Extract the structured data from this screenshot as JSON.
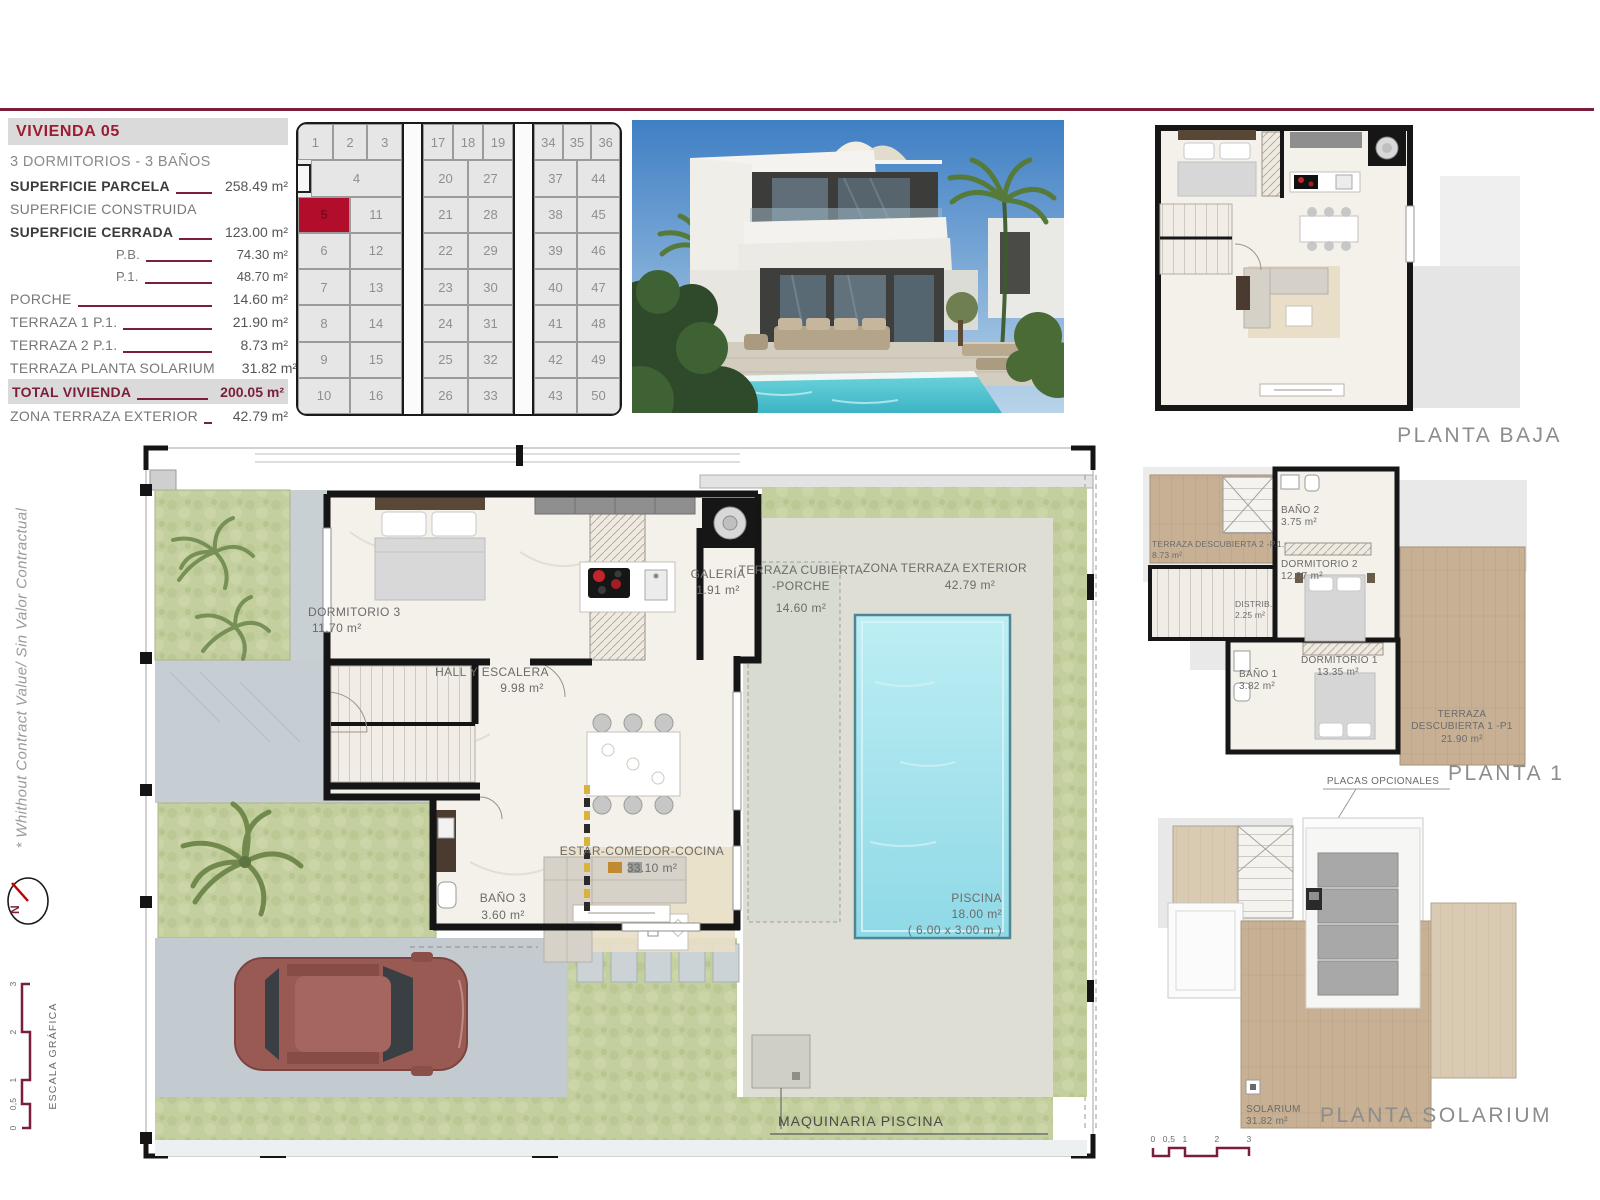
{
  "info_panel": {
    "title": "VIVIENDA 05",
    "subtitle": "3 DORMITORIOS - 3 BAÑOS",
    "rows": [
      {
        "label": "SUPERFICIE PARCELA",
        "value": "258.49 m²",
        "style": "bold"
      },
      {
        "label": "SUPERFICIE CONSTRUIDA",
        "value": "",
        "style": "plain-nolead"
      },
      {
        "label": "SUPERFICIE CERRADA",
        "value": "123.00 m²",
        "style": "bold"
      },
      {
        "label": "P.B.",
        "value": "74.30 m²",
        "style": "indent"
      },
      {
        "label": "P.1.",
        "value": "48.70 m²",
        "style": "indent"
      },
      {
        "label": "PORCHE",
        "value": "14.60 m²",
        "style": "plain"
      },
      {
        "label": "TERRAZA 1 P.1.",
        "value": "21.90 m²",
        "style": "plain"
      },
      {
        "label": "TERRAZA 2 P.1.",
        "value": "8.73 m²",
        "style": "plain"
      },
      {
        "label": "TERRAZA PLANTA SOLARIUM",
        "value": "31.82 m²",
        "style": "plain"
      },
      {
        "label": "TOTAL VIVIENDA",
        "value": "200.05 m²",
        "style": "total"
      },
      {
        "label": "ZONA TERRAZA EXTERIOR",
        "value": "42.79 m²",
        "style": "plain"
      }
    ]
  },
  "site_plan": {
    "highlighted": "5",
    "blocks": [
      {
        "top_row": [
          "1",
          "2",
          "3"
        ],
        "wide_cell": "4",
        "pairs": [
          [
            "5",
            "11"
          ],
          [
            "6",
            "12"
          ],
          [
            "7",
            "13"
          ],
          [
            "8",
            "14"
          ],
          [
            "9",
            "15"
          ],
          [
            "10",
            "16"
          ]
        ]
      },
      {
        "top_row": [
          "17",
          "18",
          "19"
        ],
        "pairs": [
          [
            "20",
            "27"
          ],
          [
            "21",
            "28"
          ],
          [
            "22",
            "29"
          ],
          [
            "23",
            "30"
          ],
          [
            "24",
            "31"
          ],
          [
            "25",
            "32"
          ],
          [
            "26",
            "33"
          ]
        ]
      },
      {
        "top_row": [
          "34",
          "35",
          "36"
        ],
        "pairs": [
          [
            "37",
            "44"
          ],
          [
            "38",
            "45"
          ],
          [
            "39",
            "46"
          ],
          [
            "40",
            "47"
          ],
          [
            "41",
            "48"
          ],
          [
            "42",
            "49"
          ],
          [
            "43",
            "50"
          ]
        ]
      }
    ]
  },
  "main_plan": {
    "rooms": {
      "dormitorio3": {
        "name": "DORMITORIO 3",
        "area": "11.70 m²"
      },
      "hall": {
        "name": "HALL Y ESCALERA",
        "area": "9.98 m²"
      },
      "galeria": {
        "name": "GALERÍA",
        "area": "1.91 m²"
      },
      "estar": {
        "name": "ESTAR-COMEDOR-COCINA",
        "area": "33.10 m²"
      },
      "bano3": {
        "name": "BAÑO 3",
        "area": "3.60 m²"
      },
      "porche": {
        "line1": "TERRAZA CUBIERTA",
        "line2": "-PORCHE",
        "area": "14.60 m²"
      },
      "zona_terraza": {
        "name": "ZONA TERRAZA EXTERIOR",
        "area": "42.79 m²"
      },
      "piscina": {
        "name": "PISCINA",
        "area": "18.00 m²",
        "dims": "( 6.00 x 3.00 m )"
      },
      "maquinaria": {
        "name": "MAQUINARIA PISCINA"
      }
    }
  },
  "floor_plans": {
    "baja": {
      "label": "PLANTA BAJA"
    },
    "p1": {
      "label": "PLANTA 1",
      "rooms": {
        "terraza2": {
          "line1": "TERRAZA DESCUBIERTA 2 -P.1.",
          "area": "8.73 m²"
        },
        "bano2": {
          "name": "BAÑO 2",
          "area": "3.75 m²"
        },
        "dormitorio2": {
          "name": "DORMITORIO 2",
          "area": "12.07 m²"
        },
        "distrib": {
          "name": "DISTRIB.",
          "area": "2.25 m²"
        },
        "bano1": {
          "name": "BAÑO 1",
          "area": "3.82 m²"
        },
        "dormitorio1": {
          "name": "DORMITORIO 1",
          "area": "13.35 m²"
        },
        "terraza1": {
          "line1": "TERRAZA",
          "line2": "DESCUBIERTA 1 -P1",
          "area": "21.90 m²"
        }
      }
    },
    "solarium": {
      "label": "PLANTA SOLARIUM",
      "placas": "PLACAS OPCIONALES",
      "room": {
        "name": "SOLARIUM",
        "area": "31.82 m²"
      },
      "scale_ticks": [
        "0",
        "0,5",
        "1",
        "2",
        "3"
      ]
    }
  },
  "side_notes": {
    "disclaimer": "* Whithout Contract Value/ Sin Valor Contractual",
    "compass_n": "N",
    "escala_label": "ESCALA GRÁFICA",
    "scale_ticks": [
      "0",
      "0,5",
      "1",
      "2",
      "3"
    ]
  }
}
